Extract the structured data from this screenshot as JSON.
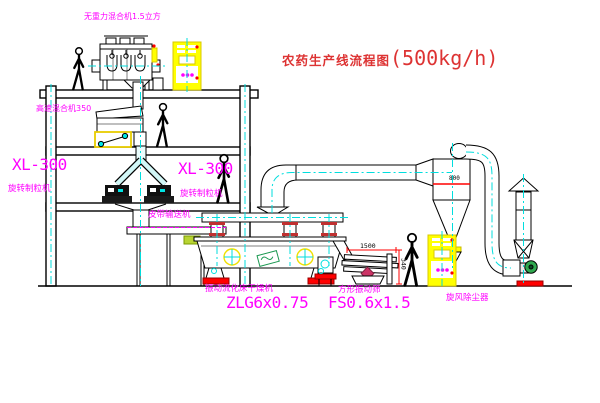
{
  "title": {
    "text": "农药生产线流程图",
    "capacity": "(500kg/h)"
  },
  "labels": {
    "gravity_mixer": "无重力混合机1.5立方",
    "high_speed_mixer": "高速混合机350",
    "xl300_left": "XL-300",
    "granulator_left": "旋转制粒机",
    "xl300_right": "XL-300",
    "granulator_right": "旋转制粒机",
    "belt_conveyor": "皮带输送机",
    "dryer_name": "振动流化床干燥机",
    "dryer_model": "ZLG6x0.75",
    "sieve_name": "方形振动筛",
    "sieve_model": "FS0.6x1.5",
    "cyclone": "旋风除尘器",
    "fan": "引风机"
  },
  "dimensions": {
    "sieve_length": "1500",
    "sieve_height": "340",
    "cyclone_band": "800"
  },
  "colors": {
    "title_red": "#dd3333",
    "label_magenta": "#ff00ff",
    "centerline_cyan": "#00dede",
    "cabinet_yellow": "#ffff00",
    "accent_red": "#ff0000",
    "motor_green": "#2fa84f"
  }
}
